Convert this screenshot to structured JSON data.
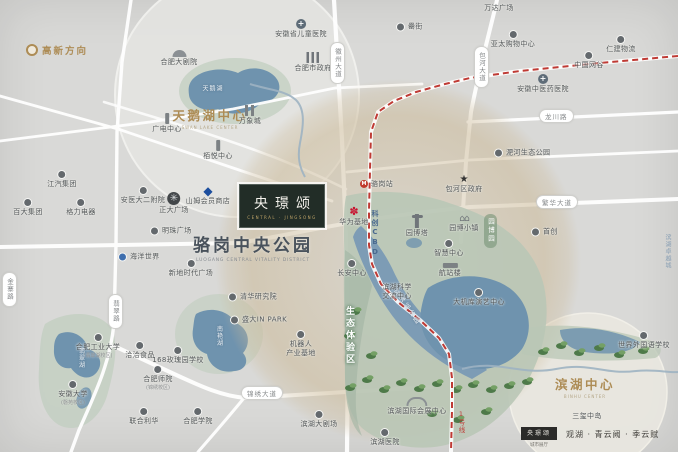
{
  "colors": {
    "gold": "#ad8c55",
    "metro_red": "#bf3a34",
    "water": "#6f93ae",
    "park_green": "#b9c7b6",
    "sam_blue": "#1c4e9e",
    "huawei_red": "#c8102e",
    "road_white": "#ffffff"
  },
  "logo": {
    "name": "央璟颂",
    "en": "CENTRAL · JINGSONG"
  },
  "park_title": {
    "cn": "骆岗中央公园",
    "en": "LUOGANG CENTRAL VITALITY DISTRICT"
  },
  "districts": {
    "gaoxin": {
      "label": "高新方向"
    },
    "swan": {
      "label": "天鹅湖中心",
      "en": "SWAN LAKE CENTER"
    },
    "binhu": {
      "label": "滨湖中心",
      "en": "BINHU CENTER"
    }
  },
  "zones": {
    "eco": {
      "label": "生态体验区"
    },
    "expo": {
      "label": "园博园"
    },
    "cbd": {
      "label": "科创CBD"
    },
    "jinxiu_lake": {
      "label": "锦绣湖公园"
    },
    "zhuoyue": {
      "label": "滨湖卓越城"
    }
  },
  "metro": {
    "line_label": "1号线",
    "station": "骆岗站"
  },
  "roads": [
    {
      "label": "徽州大道",
      "x": 330,
      "y": 42,
      "vertical": true
    },
    {
      "label": "包河大道",
      "x": 474,
      "y": 46,
      "vertical": true
    },
    {
      "label": "龙川路",
      "x": 539,
      "y": 109,
      "vertical": false
    },
    {
      "label": "繁华大道",
      "x": 536,
      "y": 195,
      "vertical": false
    },
    {
      "label": "锦绣大道",
      "x": 241,
      "y": 386,
      "vertical": false
    },
    {
      "label": "翡翠路",
      "x": 108,
      "y": 294,
      "vertical": true
    },
    {
      "label": "金寨路",
      "x": 2,
      "y": 272,
      "vertical": true
    }
  ],
  "lakes": [
    {
      "label": "天鹅湖",
      "x": 213,
      "y": 88,
      "vertical": false
    },
    {
      "label": "南艳湖",
      "x": 219,
      "y": 336,
      "vertical": true
    },
    {
      "label": "翡翠湖",
      "x": 81,
      "y": 358,
      "vertical": true
    }
  ],
  "pois": [
    {
      "label": "江汽集团",
      "x": 62,
      "y": 170,
      "icon": "dot",
      "layout": "v"
    },
    {
      "label": "百大集团",
      "x": 28,
      "y": 198,
      "icon": "dot",
      "layout": "v"
    },
    {
      "label": "格力电器",
      "x": 81,
      "y": 198,
      "icon": "dot",
      "layout": "v"
    },
    {
      "label": "安医大二附院",
      "x": 143,
      "y": 186,
      "icon": "dot",
      "layout": "v"
    },
    {
      "label": "正大广场",
      "x": 174,
      "y": 192,
      "icon": "wheel",
      "layout": "v"
    },
    {
      "label": "山姆会员商店",
      "x": 208,
      "y": 186,
      "icon": "diamond",
      "layout": "v"
    },
    {
      "label": "栢悦中心",
      "x": 218,
      "y": 140,
      "icon": "tower",
      "layout": "v"
    },
    {
      "label": "明珠广场",
      "x": 150,
      "y": 231,
      "icon": "dot",
      "layout": "h"
    },
    {
      "label": "海洋世界",
      "x": 118,
      "y": 257,
      "icon": "blue",
      "layout": "h"
    },
    {
      "label": "新地时代广场",
      "x": 191,
      "y": 259,
      "icon": "dot",
      "layout": "v"
    },
    {
      "label": "广电中心",
      "x": 167,
      "y": 113,
      "icon": "tower",
      "layout": "v"
    },
    {
      "label": "万象城",
      "x": 250,
      "y": 105,
      "icon": "towers",
      "layout": "v"
    },
    {
      "label": "合肥大剧院",
      "x": 179,
      "y": 50,
      "icon": "theater",
      "layout": "v"
    },
    {
      "label": "合肥市政府",
      "x": 313,
      "y": 52,
      "icon": "gov",
      "layout": "v"
    },
    {
      "label": "安徽省儿童医院",
      "x": 301,
      "y": 19,
      "icon": "cross",
      "layout": "v"
    },
    {
      "label": "罍街",
      "x": 396,
      "y": 27,
      "icon": "dot",
      "layout": "h"
    },
    {
      "label": "万达广场",
      "x": 499,
      "y": 4,
      "icon": "none",
      "layout": "t"
    },
    {
      "label": "亚太购物中心",
      "x": 513,
      "y": 30,
      "icon": "dot",
      "layout": "v"
    },
    {
      "label": "中国网谷",
      "x": 589,
      "y": 51,
      "icon": "dot",
      "layout": "v"
    },
    {
      "label": "仁建物流",
      "x": 621,
      "y": 35,
      "icon": "dot",
      "layout": "v"
    },
    {
      "label": "安徽中医药医院",
      "x": 543,
      "y": 74,
      "icon": "cross",
      "layout": "v"
    },
    {
      "label": "淝河生态公园",
      "x": 494,
      "y": 153,
      "icon": "dot",
      "layout": "h"
    },
    {
      "label": "包河区政府",
      "x": 464,
      "y": 175,
      "icon": "star",
      "layout": "v"
    },
    {
      "label": "首创",
      "x": 531,
      "y": 232,
      "icon": "dot",
      "layout": "h"
    },
    {
      "label": "园博塔",
      "x": 417,
      "y": 214,
      "icon": "pagoda",
      "layout": "v"
    },
    {
      "label": "园博小镇",
      "x": 464,
      "y": 215,
      "icon": "houses",
      "layout": "v"
    },
    {
      "label": "智慧中心",
      "x": 449,
      "y": 239,
      "icon": "dot",
      "layout": "v"
    },
    {
      "label": "航站楼",
      "x": 450,
      "y": 263,
      "icon": "terminal",
      "layout": "v"
    },
    {
      "label": "大机库演艺中心",
      "x": 479,
      "y": 288,
      "icon": "dot",
      "layout": "v"
    },
    {
      "label": "滨湖科学",
      "sub2": "交流中心",
      "x": 397,
      "y": 283,
      "icon": "none",
      "layout": "v2"
    },
    {
      "label": "华为基地",
      "x": 354,
      "y": 207,
      "icon": "huawei",
      "layout": "v"
    },
    {
      "label": "骆岗站",
      "x": 360,
      "y": 184,
      "icon": "metro",
      "layout": "h"
    },
    {
      "label": "长安中心",
      "x": 352,
      "y": 259,
      "icon": "dot",
      "layout": "v"
    },
    {
      "label": "清华研究院",
      "x": 228,
      "y": 297,
      "icon": "dot",
      "layout": "h"
    },
    {
      "label": "盛大IN PARK",
      "x": 230,
      "y": 320,
      "icon": "dot",
      "layout": "h"
    },
    {
      "label": "机器人",
      "sub2": "产业基地",
      "x": 301,
      "y": 330,
      "icon": "dot",
      "layout": "v2"
    },
    {
      "label": "洽洽食品",
      "x": 140,
      "y": 341,
      "icon": "dot",
      "layout": "v"
    },
    {
      "label": "168玫瑰园学校",
      "x": 178,
      "y": 346,
      "icon": "dot",
      "layout": "v"
    },
    {
      "label": "合肥工业大学",
      "sub": "(翡翠湖校区)",
      "x": 98,
      "y": 333,
      "icon": "dot",
      "layout": "v"
    },
    {
      "label": "安徽大学",
      "sub": "(磬苑校区)",
      "x": 73,
      "y": 380,
      "icon": "dot",
      "layout": "v"
    },
    {
      "label": "合肥师院",
      "sub": "(锦绣校区)",
      "x": 158,
      "y": 365,
      "icon": "dot",
      "layout": "v"
    },
    {
      "label": "联合利华",
      "x": 144,
      "y": 407,
      "icon": "dot",
      "layout": "v"
    },
    {
      "label": "合肥学院",
      "x": 198,
      "y": 407,
      "icon": "dot",
      "layout": "v"
    },
    {
      "label": "滨湖大剧场",
      "x": 319,
      "y": 410,
      "icon": "dot",
      "layout": "v"
    },
    {
      "label": "滨湖医院",
      "x": 385,
      "y": 428,
      "icon": "dot",
      "layout": "v"
    },
    {
      "label": "滨湖国际会展中心",
      "x": 417,
      "y": 397,
      "icon": "arc",
      "layout": "v"
    },
    {
      "label": "世界外国语学校",
      "x": 644,
      "y": 331,
      "icon": "dot",
      "layout": "v"
    },
    {
      "label": "三玺中岛",
      "x": 587,
      "y": 412,
      "icon": "none",
      "layout": "t"
    }
  ],
  "footer": {
    "badge": "央璟颂",
    "badge_sub": "城市展厅",
    "projects": "观湖 · 青云阙 · 季云赋"
  }
}
